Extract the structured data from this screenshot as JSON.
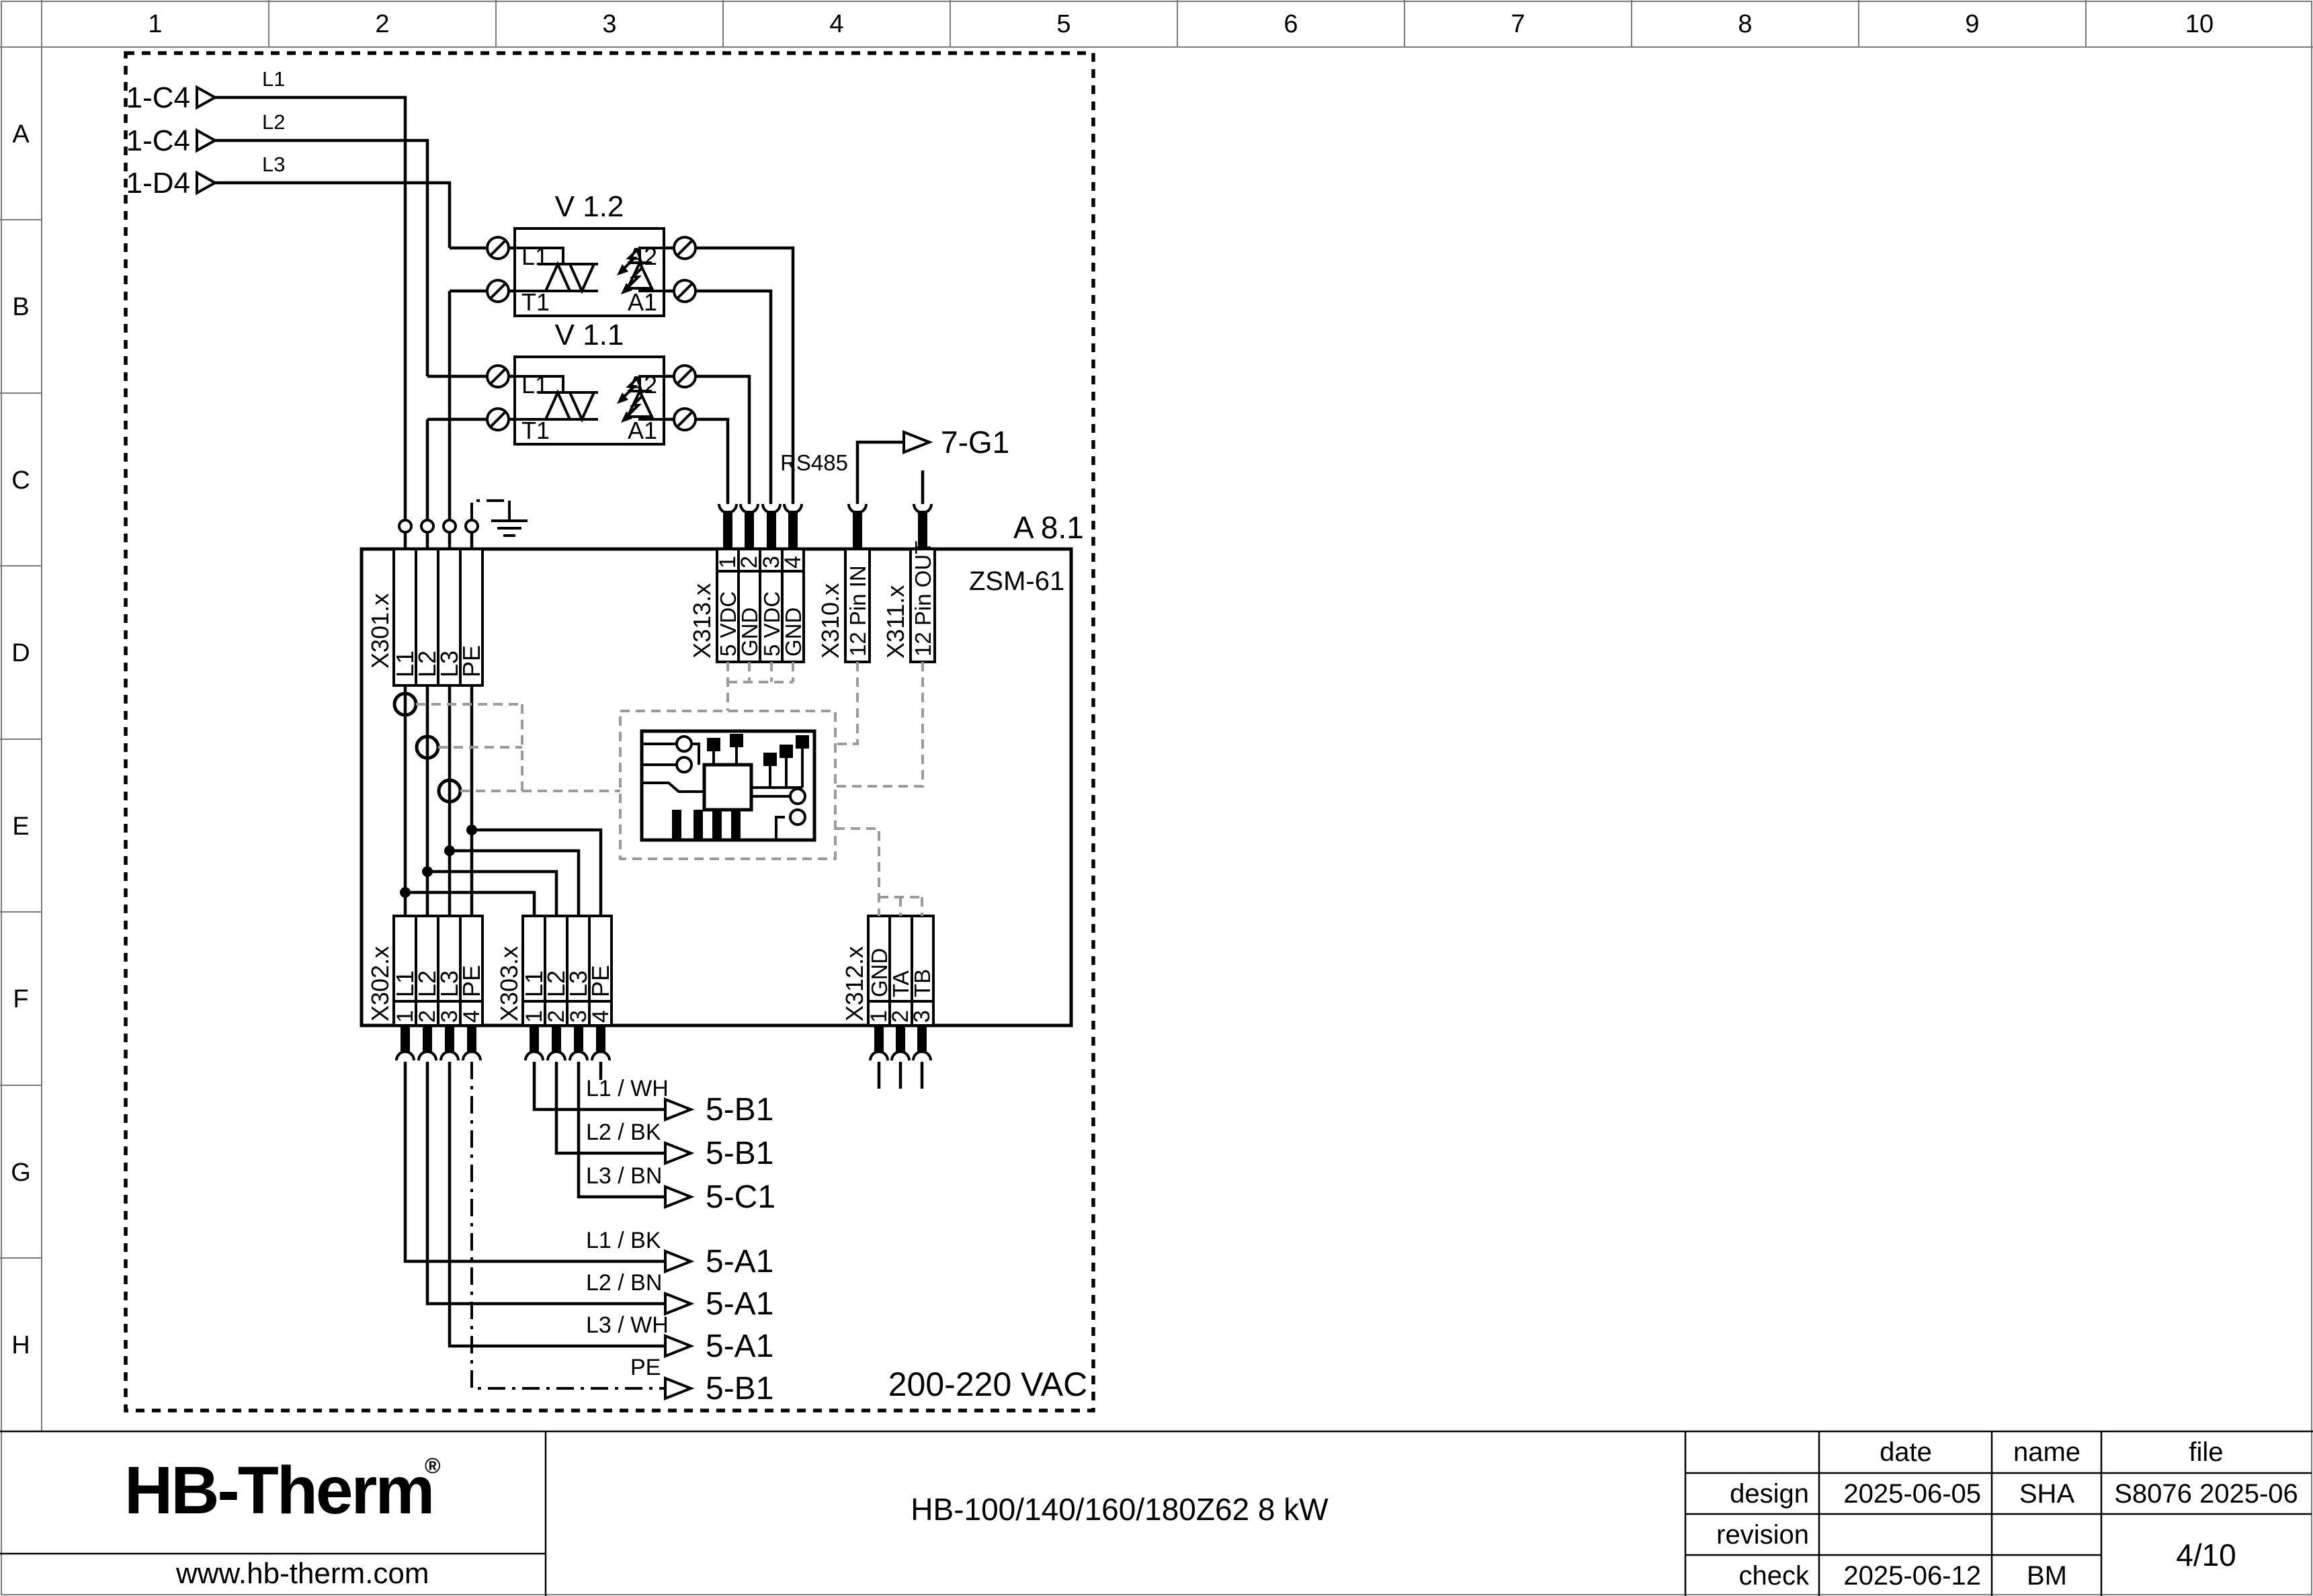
{
  "sheet": {
    "grid_columns": [
      "1",
      "2",
      "3",
      "4",
      "5",
      "6",
      "7",
      "8",
      "9",
      "10"
    ],
    "grid_rows": [
      "A",
      "B",
      "C",
      "D",
      "E",
      "F",
      "G",
      "H"
    ],
    "power_note": "200-220 VAC"
  },
  "colors": {
    "logo": "#1a2b4f"
  },
  "sources": [
    {
      "ref": "1-C4",
      "phase": "L1"
    },
    {
      "ref": "1-C4",
      "phase": "L2"
    },
    {
      "ref": "1-D4",
      "phase": "L3"
    }
  ],
  "ssr": [
    {
      "name": "V 1.2",
      "terminals": {
        "l1": "L1",
        "a2": "A2",
        "t1": "T1",
        "a1": "A1"
      }
    },
    {
      "name": "V 1.1",
      "terminals": {
        "l1": "L1",
        "a2": "A2",
        "t1": "T1",
        "a1": "A1"
      }
    }
  ],
  "comm": {
    "bus": "RS485",
    "dest": "7-G1"
  },
  "module": {
    "ref": "A 8.1",
    "type": "ZSM-61",
    "x301": {
      "label": "X301.x",
      "cells": [
        "L1",
        "L2",
        "L3",
        "PE"
      ]
    },
    "x313": {
      "label": "X313.x",
      "numbers": [
        "1",
        "2",
        "3",
        "4"
      ],
      "signals": [
        "5 VDC",
        "GND",
        "5 VDC",
        "GND"
      ]
    },
    "x310": {
      "label": "X310.x",
      "signal": "12 Pin IN"
    },
    "x311": {
      "label": "X311.x",
      "signal": "12 Pin OUT"
    },
    "x302": {
      "label": "X302.x",
      "numbers": [
        "1",
        "2",
        "3",
        "4"
      ],
      "signals": [
        "L1",
        "L2",
        "L3",
        "PE"
      ]
    },
    "x303": {
      "label": "X303.x",
      "numbers": [
        "1",
        "2",
        "3",
        "4"
      ],
      "signals": [
        "L1",
        "L2",
        "L3",
        "PE"
      ]
    },
    "x312": {
      "label": "X312.x",
      "numbers": [
        "1",
        "2",
        "3"
      ],
      "signals": [
        "GND",
        "TA",
        "TB"
      ]
    }
  },
  "outputs_top": [
    {
      "wire": "L1 / WH",
      "dest": "5-B1"
    },
    {
      "wire": "L2 / BK",
      "dest": "5-B1"
    },
    {
      "wire": "L3 / BN",
      "dest": "5-C1"
    }
  ],
  "outputs_bottom": [
    {
      "wire": "L1 / BK",
      "dest": "5-A1"
    },
    {
      "wire": "L2 / BN",
      "dest": "5-A1"
    },
    {
      "wire": "L3 / WH",
      "dest": "5-A1"
    },
    {
      "wire": "PE",
      "dest": "5-B1"
    }
  ],
  "titleblock": {
    "logo": "HB-Therm",
    "reg": "®",
    "website": "www.hb-therm.com",
    "doc_title": "HB-100/140/160/180Z62 8 kW",
    "col_date": "date",
    "col_name": "name",
    "col_file": "file",
    "row_design": "design",
    "row_revision": "revision",
    "row_check": "check",
    "design_date": "2025-06-05",
    "design_name": "SHA",
    "file_ref": "S8076 2025-06",
    "check_date": "2025-06-12",
    "check_name": "BM",
    "page": "4/10"
  }
}
